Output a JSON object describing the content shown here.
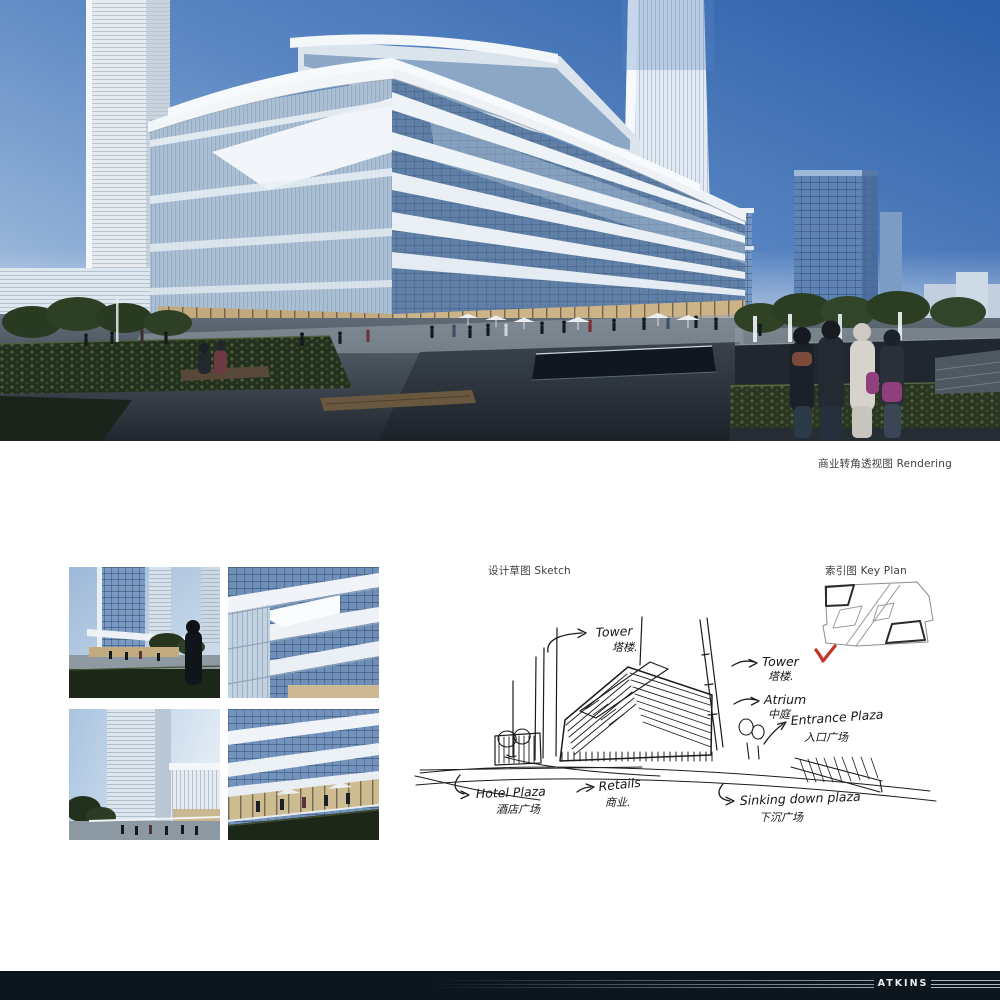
{
  "rendering": {
    "caption": "商业转角透视图 Rendering"
  },
  "sketch": {
    "label": "设计草图 Sketch",
    "annotations": {
      "tower1": {
        "en": "Tower",
        "zh": "塔楼."
      },
      "tower2": {
        "en": "Tower",
        "zh": "塔楼."
      },
      "atrium": {
        "en": "Atrium",
        "zh": "中庭"
      },
      "entrance": {
        "en": "Entrance Plaza",
        "zh": "入口广场"
      },
      "hotel": {
        "en": "Hotel Plaza",
        "zh": "酒店广场"
      },
      "retails": {
        "en": "Retails",
        "zh": "商业."
      },
      "sinking": {
        "en": "Sinking down plaza",
        "zh": "下沉广场"
      }
    }
  },
  "key_plan": {
    "label": "索引图 Key Plan"
  },
  "footer": {
    "brand": "ATKINS",
    "bar_color": "#0d151d"
  },
  "colors": {
    "accent_red": "#c23428",
    "sky_deep": "#2b5ea9",
    "sky_light": "#cfdcec"
  }
}
